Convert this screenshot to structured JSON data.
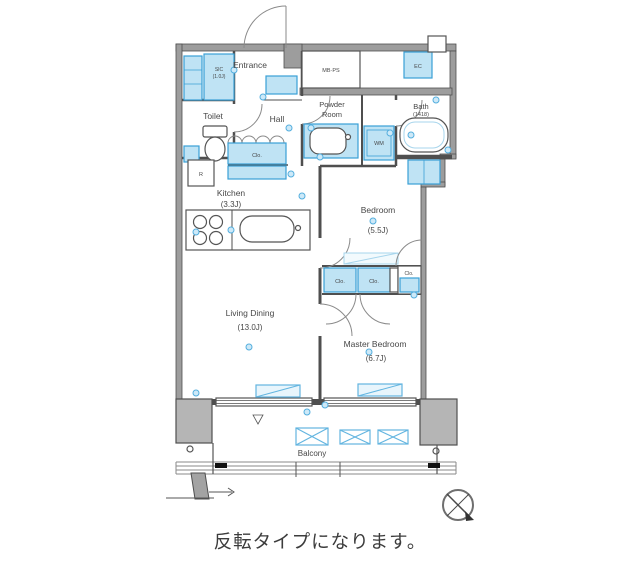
{
  "caption": "反転タイプになります。",
  "rooms": {
    "entrance": {
      "label": "Entrance"
    },
    "toilet": {
      "label": "Toilet"
    },
    "hall": {
      "label": "Hall"
    },
    "powder_room": {
      "line1": "Powder",
      "line2": "Room"
    },
    "bath": {
      "label": "Bath",
      "size": "(1418)"
    },
    "kitchen": {
      "label": "Kitchen",
      "size": "(3.3J)"
    },
    "bedroom": {
      "label": "Bedroom",
      "size": "(5.5J)"
    },
    "living_dining": {
      "label": "Living Dining",
      "size": "(13.0J)"
    },
    "master_bedroom": {
      "label": "Master Bedroom",
      "size": "(6.7J)"
    },
    "balcony": {
      "label": "Balcony"
    }
  },
  "storage": {
    "sic": {
      "label": "SIC",
      "size": "(1.0J)"
    },
    "hall_closet": {
      "label": "Clo."
    },
    "bedroom_closet_left": {
      "label": "Clo."
    },
    "bedroom_closet_right": {
      "label": "Clo."
    },
    "master_closet": {
      "label": "Clo."
    }
  },
  "equipment": {
    "meter_box": {
      "label": "MB·PS"
    },
    "electrical_closet": {
      "label": "EC"
    },
    "washing_machine": {
      "label": "WM"
    },
    "refrigerator": {
      "label": "R"
    }
  },
  "colors": {
    "wall_gray": "#4f4f4f",
    "concrete_gray": "#b5b5b5",
    "fixture_blue_stroke": "#3aa0d6",
    "fixture_blue_fill": "#bfe3f4",
    "text_gray": "#474747"
  }
}
